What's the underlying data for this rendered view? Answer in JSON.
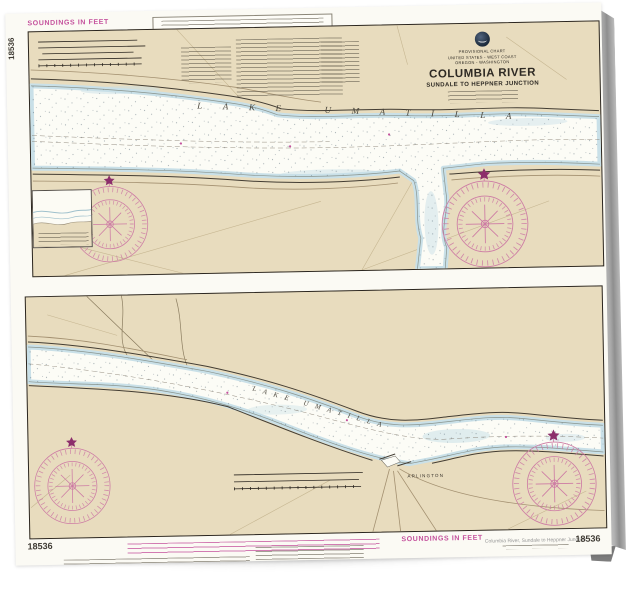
{
  "canvas": {
    "chart_number": "18536",
    "soundings_label": "SOUNDINGS IN FEET",
    "caption": "Columbia River, Sundale to Heppner Junction",
    "title_block": {
      "type_line": "PROVISIONAL CHART",
      "region_line": "UNITED STATES - WEST COAST",
      "state_line": "OREGON - WASHINGTON",
      "title": "COLUMBIA RIVER",
      "subtitle": "SUNDALE TO HEPPNER JUNCTION"
    },
    "map_labels": {
      "lake_top_panel": "LAKE UMATILLA",
      "lake_bottom_panel": "LAKE UMATILLA",
      "town": "ARLINGTON"
    },
    "colors": {
      "land": "#e8dcbe",
      "water": "#fcfcf6",
      "shallow": "#c9e0e8",
      "magenta": "#c4509c",
      "rose": "#cd7ba4",
      "line": "#2b2620",
      "road": "#a39070",
      "rail": "#433d33",
      "ink": "#39332b"
    }
  }
}
